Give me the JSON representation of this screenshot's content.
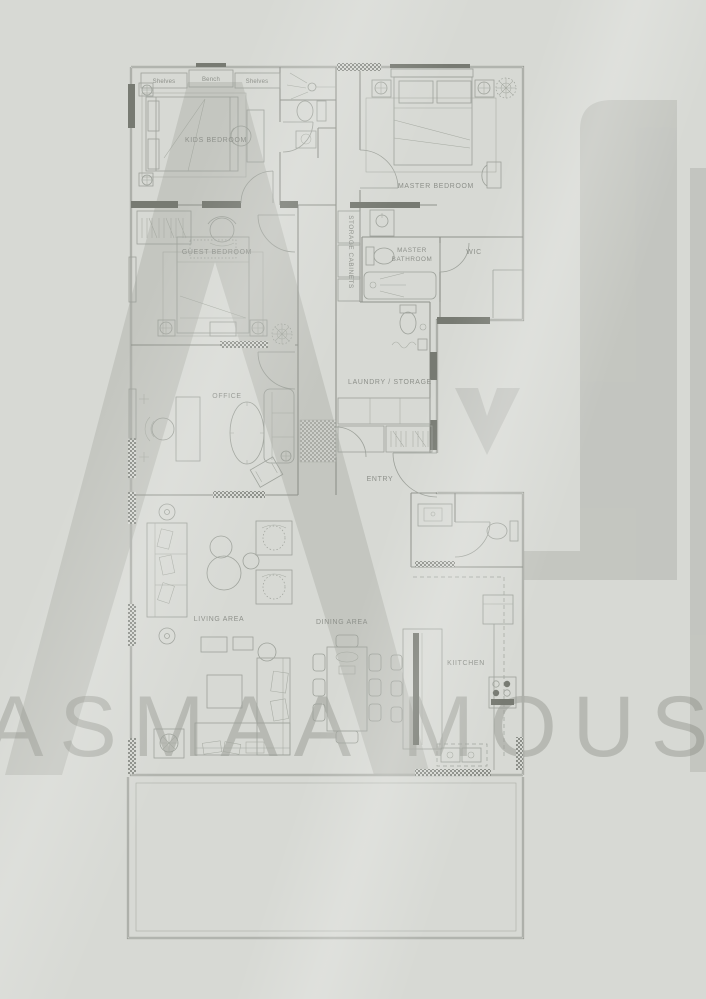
{
  "page": {
    "width": 706,
    "height": 999,
    "background": "#d7d9d4"
  },
  "watermark": {
    "brand": "ASMAA MOUSA",
    "monogram": "AM"
  },
  "colors": {
    "background": "#d7d9d4",
    "plan_line": "#8f928b",
    "plan_dark_wall": "#777a72",
    "label_text": "#8d908a",
    "watermark_fill": "#787b72"
  },
  "labels": {
    "shelves_left": "Shelves",
    "bench": "Bench",
    "shelves_right": "Shelves",
    "kids_bedroom": "KIDS BEDROOM",
    "master_bedroom": "MASTER BEDROOM",
    "guest_bedroom": "GUEST BEDROOM",
    "office": "OFFICE",
    "storage_cabinets": "STORAGE CABINETS",
    "master_bathroom_line1": "MASTER",
    "master_bathroom_line2": "BATHROOM",
    "wic": "WIC",
    "laundry_storage": "LAUNDRY / STORAGE",
    "entry": "ENTRY",
    "living_area": "LIVING AREA",
    "dining_area": "DINING AREA",
    "kitchen": "KIITCHEN"
  }
}
